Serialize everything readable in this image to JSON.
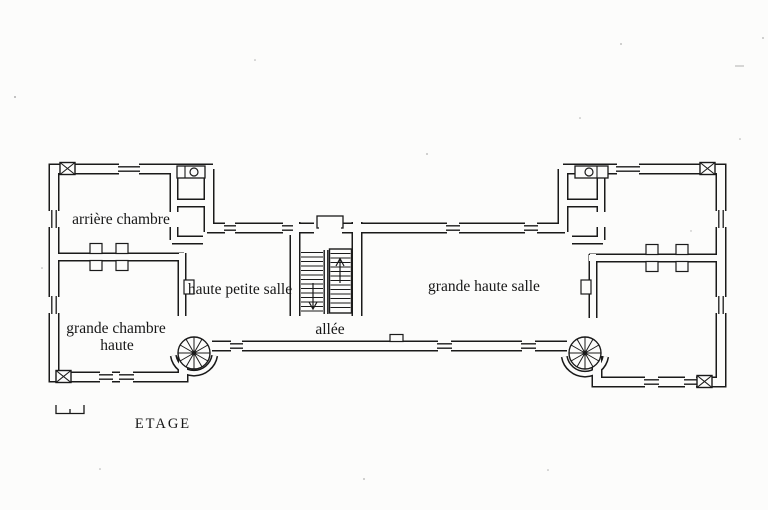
{
  "page": {
    "kind": "scanned architectural floor plan (upper storey of a château)",
    "background": "#fcfcfb",
    "ink": "#1a1a1a"
  },
  "labels": [
    {
      "id": "arriere-chambre",
      "text": "arrière chambre"
    },
    {
      "id": "haute-petite-salle",
      "text": "haute petite salle"
    },
    {
      "id": "grande-haute-salle",
      "text": "grande haute salle"
    },
    {
      "id": "allee",
      "text": "allée"
    },
    {
      "id": "grande-chambre-haute-line1",
      "text": "grande chambre"
    },
    {
      "id": "grande-chambre-haute-line2",
      "text": "haute"
    },
    {
      "id": "caption",
      "text": "ETAGE"
    }
  ],
  "features": [
    "left-pavilion",
    "right-pavilion",
    "central-range",
    "corridor-allee",
    "main-double-flight-staircase",
    "stair-up-arrow",
    "stair-down-arrow",
    "spiral-staircase-left",
    "spiral-staircase-right",
    "fireplace-wall-left",
    "fireplace-wall-right",
    "latrine-closet-left",
    "latrine-closet-right",
    "corner-block-nw",
    "corner-block-sw",
    "corner-block-ne",
    "corner-block-se",
    "window-openings",
    "scale-bar"
  ]
}
